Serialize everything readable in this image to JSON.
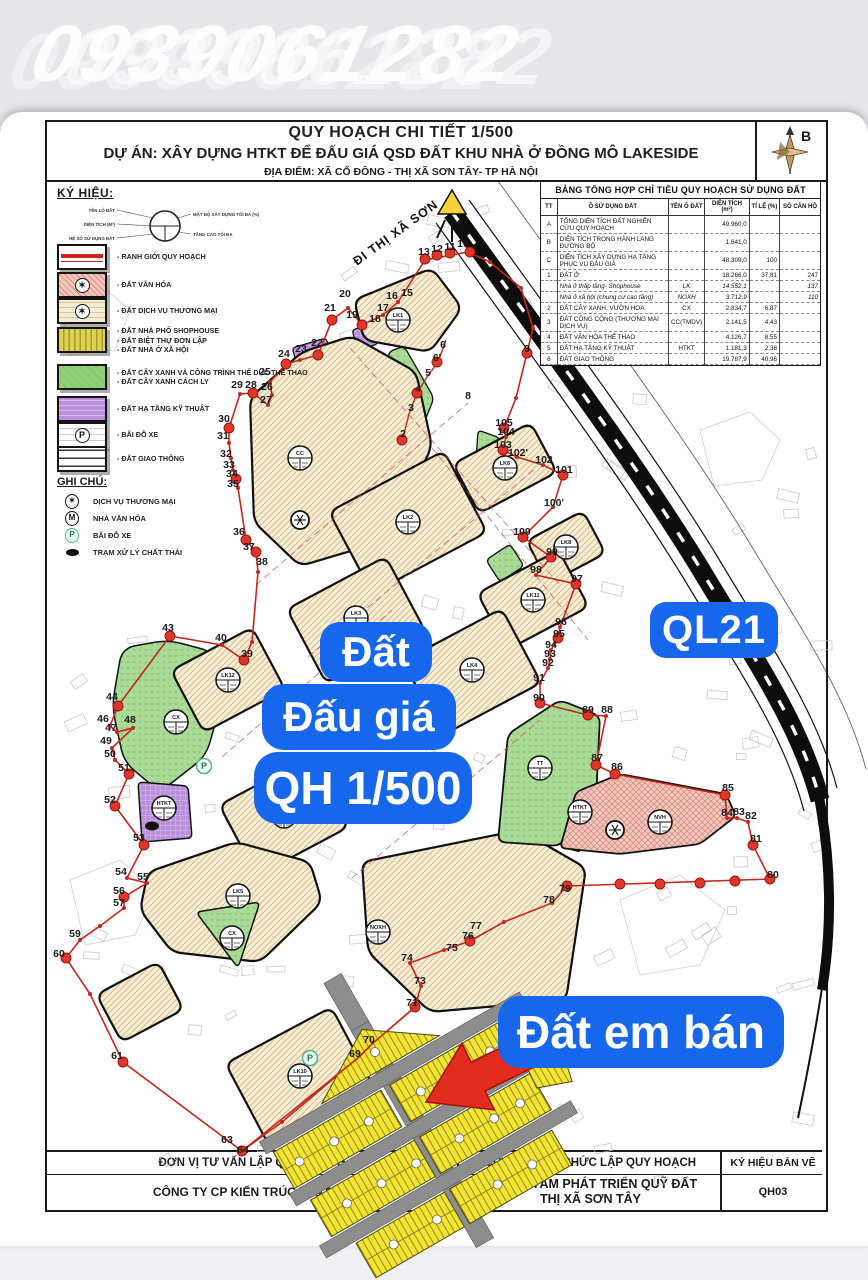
{
  "watermark": "0939061282",
  "title_block": {
    "line1": "QUY HOẠCH CHI TIẾT 1/500",
    "line2": "DỰ ÁN: XÂY DỰNG HTKT ĐỂ ĐẤU GIÁ QSD ĐẤT KHU NHÀ Ở ĐỒNG MÔ LAKESIDE",
    "line3": "ĐỊA ĐIỂM: XÃ CỔ ĐÔNG - THỊ XÃ SƠN TÂY- TP HÀ NỘI",
    "compass_label": "B"
  },
  "legend": {
    "heading": "KÝ HIỆU:",
    "diagram_left_labels": [
      "TÊN LÔ ĐẤT",
      "DIỆN TÍCH (M²)",
      "HỆ SỐ SỬ DỤNG ĐẤT"
    ],
    "diagram_right_labels": [
      "MẬT ĐỘ XÂY DỰNG TỐI ĐA (%)",
      "TẦNG CAO TỐI ĐA"
    ],
    "items": [
      {
        "swatch": "boundary",
        "lines": [
          "- RANH GIỚI QUY HOẠCH"
        ]
      },
      {
        "swatch": "culture",
        "sym": "✶",
        "lines": [
          "- ĐẤT VĂN HÓA"
        ]
      },
      {
        "swatch": "commerce",
        "sym": "✶",
        "lines": [
          "- ĐẤT DỊCH VỤ THƯƠNG MẠI"
        ]
      },
      {
        "swatch": "housing",
        "lines": [
          "- ĐẤT NHÀ PHỐ SHOPHOUSE",
          "- ĐẤT BIỆT THỰ ĐƠN LẬP",
          "- ĐẤT NHÀ Ở XÃ HỘI"
        ]
      },
      {
        "swatch": "green",
        "lines": [
          "- ĐẤT CÂY XANH VÀ CÔNG TRÌNH THỂ DỤC THỂ THAO",
          "- ĐẤT CÂY XANH CÁCH LY"
        ]
      },
      {
        "swatch": "infra",
        "lines": [
          "- ĐẤT HẠ TẦNG KỸ THUẬT"
        ]
      },
      {
        "swatch": "parking",
        "sym": "P",
        "lines": [
          "- BÃI ĐỖ XE"
        ]
      },
      {
        "swatch": "traffic",
        "lines": [
          "- ĐẤT GIAO THÔNG"
        ]
      }
    ],
    "notes_heading": "GHI CHÚ:",
    "notes": [
      {
        "icon": "tm",
        "label": "DỊCH VỤ THƯƠNG MẠI"
      },
      {
        "icon": "m",
        "label": "NHÀ VĂN HÓA"
      },
      {
        "icon": "p",
        "label": "BÃI ĐỖ XE"
      },
      {
        "icon": "waste",
        "label": "TRẠM XỬ LÝ CHẤT THẢI"
      }
    ]
  },
  "table": {
    "title": "BẢNG TỔNG HỢP CHỈ TIÊU QUY HOẠCH SỬ DỤNG ĐẤT",
    "headers": [
      "TT",
      "Ô SỬ DỤNG ĐẤT",
      "TÊN Ô ĐẤT",
      "DIỆN TÍCH (m²)",
      "TỈ LỆ (%)",
      "SỐ CĂN HỘ"
    ],
    "rows": [
      {
        "tt": "A",
        "name": "TỔNG DIỆN TÍCH ĐẤT NGHIÊN CỨU QUY HOẠCH",
        "ten": "",
        "dt": "49.960,0",
        "tl": "",
        "so": "",
        "sub": false
      },
      {
        "tt": "B",
        "name": "DIỆN TÍCH TRONG HÀNH LANG ĐƯỜNG BỘ",
        "ten": "",
        "dt": "1.641,0",
        "tl": "",
        "so": "",
        "sub": false
      },
      {
        "tt": "C",
        "name": "DIỆN TÍCH XÂY DỰNG HẠ TẦNG PHỤC VỤ ĐẤU GIÁ",
        "ten": "",
        "dt": "48.309,0",
        "tl": "100",
        "so": "",
        "sub": false
      },
      {
        "tt": "1",
        "name": "ĐẤT Ở",
        "ten": "",
        "dt": "18.266,0",
        "tl": "37,81",
        "so": "247",
        "sub": false
      },
      {
        "tt": "",
        "name": "Nhà ở thấp tầng- Shophouse",
        "ten": "LK",
        "dt": "14.552,1",
        "tl": "",
        "so": "137",
        "sub": true
      },
      {
        "tt": "",
        "name": "Nhà ở xã hội (chung cư cao tầng)",
        "ten": "NOXH",
        "dt": "3.712,9",
        "tl": "",
        "so": "110",
        "sub": true
      },
      {
        "tt": "2",
        "name": "ĐẤT CÂY XANH, VƯỜN HOA",
        "ten": "CX",
        "dt": "2.834,7",
        "tl": "6,87",
        "so": "",
        "sub": false
      },
      {
        "tt": "3",
        "name": "ĐẤT CÔNG CỘNG (THƯƠNG MẠI DỊCH VỤ)",
        "ten": "CC(TMDV)",
        "dt": "2.141,5",
        "tl": "4,43",
        "so": "",
        "sub": false
      },
      {
        "tt": "4",
        "name": "ĐẤT VĂN HÓA THỂ THAO",
        "ten": "",
        "dt": "4.126,7",
        "tl": "8,55",
        "so": "",
        "sub": false
      },
      {
        "tt": "5",
        "name": "ĐẤT HẠ TẦNG KỸ THUẬT",
        "ten": "HTKT",
        "dt": "1.181,3",
        "tl": "2,38",
        "so": "",
        "sub": false
      },
      {
        "tt": "6",
        "name": "ĐẤT GIAO THÔNG",
        "ten": "",
        "dt": "19.787,9",
        "tl": "40,96",
        "so": "",
        "sub": false
      }
    ]
  },
  "map": {
    "road_label": "ĐI THỊ XÃ SƠN",
    "overlays": {
      "dat": "Đất",
      "daugia": "Đấu giá",
      "qh": "QH 1/500",
      "ql21": "QL21",
      "datban": "Đất em bán"
    },
    "boundary_points": [
      [
        "2",
        403,
        437
      ],
      [
        "3",
        411,
        411
      ],
      [
        "4",
        418,
        392
      ],
      [
        "5",
        428,
        376
      ],
      [
        "6",
        443,
        348
      ],
      [
        "6'",
        437,
        361
      ],
      [
        "8",
        468,
        399
      ],
      [
        "9",
        527,
        352
      ],
      [
        "10",
        463,
        247
      ],
      [
        "11",
        450,
        250
      ],
      [
        "12",
        437,
        252
      ],
      [
        "13",
        424,
        255
      ],
      [
        "15",
        407,
        296
      ],
      [
        "16",
        392,
        299
      ],
      [
        "17",
        383,
        311
      ],
      [
        "18",
        375,
        322
      ],
      [
        "19",
        352,
        318
      ],
      [
        "20",
        345,
        297
      ],
      [
        "21",
        330,
        311
      ],
      [
        "22",
        317,
        346
      ],
      [
        "23",
        301,
        352
      ],
      [
        "24",
        284,
        357
      ],
      [
        "25",
        265,
        375
      ],
      [
        "26",
        267,
        390
      ],
      [
        "27",
        266,
        403
      ],
      [
        "28",
        251,
        388
      ],
      [
        "29",
        237,
        388
      ],
      [
        "30",
        224,
        422
      ],
      [
        "31",
        223,
        439
      ],
      [
        "32",
        226,
        457
      ],
      [
        "33",
        229,
        468
      ],
      [
        "34",
        232,
        477
      ],
      [
        "35",
        233,
        487
      ],
      [
        "36",
        239,
        535
      ],
      [
        "37",
        249,
        550
      ],
      [
        "38",
        262,
        565
      ],
      [
        "39",
        247,
        657
      ],
      [
        "40",
        221,
        641
      ],
      [
        "43",
        168,
        631
      ],
      [
        "44",
        112,
        700
      ],
      [
        "46",
        103,
        722
      ],
      [
        "47",
        111,
        731
      ],
      [
        "48",
        130,
        723
      ],
      [
        "49",
        106,
        744
      ],
      [
        "50",
        110,
        757
      ],
      [
        "51",
        124,
        771
      ],
      [
        "52",
        110,
        803
      ],
      [
        "53",
        139,
        841
      ],
      [
        "54",
        121,
        875
      ],
      [
        "55",
        143,
        880
      ],
      [
        "56",
        119,
        894
      ],
      [
        "57",
        119,
        906
      ],
      [
        "59",
        75,
        937
      ],
      [
        "60",
        59,
        957
      ],
      [
        "61",
        117,
        1059
      ],
      [
        "63",
        227,
        1143
      ],
      [
        "64",
        243,
        1153
      ],
      [
        "69",
        355,
        1057
      ],
      [
        "70",
        369,
        1043
      ],
      [
        "71",
        412,
        1006
      ],
      [
        "73",
        420,
        984
      ],
      [
        "74",
        407,
        961
      ],
      [
        "75",
        452,
        951
      ],
      [
        "76",
        468,
        939
      ],
      [
        "77",
        476,
        929
      ],
      [
        "78",
        549,
        903
      ],
      [
        "79",
        565,
        892
      ],
      [
        "80",
        773,
        878
      ],
      [
        "81",
        756,
        842
      ],
      [
        "82",
        751,
        819
      ],
      [
        "83",
        739,
        815
      ],
      [
        "84",
        727,
        816
      ],
      [
        "85",
        728,
        791
      ],
      [
        "86",
        617,
        770
      ],
      [
        "87",
        597,
        761
      ],
      [
        "88",
        607,
        713
      ],
      [
        "89",
        588,
        713
      ],
      [
        "90",
        539,
        701
      ],
      [
        "91",
        539,
        681
      ],
      [
        "92",
        548,
        666
      ],
      [
        "93",
        550,
        657
      ],
      [
        "94",
        551,
        648
      ],
      [
        "95",
        559,
        637
      ],
      [
        "96",
        561,
        625
      ],
      [
        "97",
        577,
        582
      ],
      [
        "98",
        536,
        573
      ],
      [
        "99",
        552,
        555
      ],
      [
        "100",
        522,
        535
      ],
      [
        "100'",
        554,
        506
      ],
      [
        "101",
        564,
        473
      ],
      [
        "102",
        544,
        463
      ],
      [
        "102'",
        518,
        456
      ],
      [
        "103",
        503,
        448
      ],
      [
        "104",
        506,
        435
      ],
      [
        "105",
        504,
        426
      ]
    ],
    "lot_circles": [
      [
        "LK1",
        398,
        320
      ],
      [
        "CC",
        300,
        458
      ],
      [
        "LK2",
        408,
        522
      ],
      [
        "LK3",
        356,
        618
      ],
      [
        "LK4",
        472,
        670
      ],
      [
        "LK5",
        238,
        896
      ],
      [
        "LK6",
        505,
        468
      ],
      [
        "LK7",
        284,
        816
      ],
      [
        "LK8",
        566,
        547
      ],
      [
        "LK10",
        300,
        1076
      ],
      [
        "LK11",
        533,
        600
      ],
      [
        "LK12",
        228,
        680
      ],
      [
        "NOXH",
        378,
        932
      ],
      [
        "TT",
        540,
        768
      ],
      [
        "NVH",
        660,
        822
      ],
      [
        "CX",
        232,
        938
      ],
      [
        "CX",
        176,
        722
      ],
      [
        "HTKT",
        164,
        808
      ],
      [
        "HTKT",
        580,
        812
      ]
    ]
  },
  "footer": {
    "col1_top": "ĐƠN VỊ TƯ VẤN LẬP QUY HOẠCH",
    "col1_bottom": "CÔNG TY CP KIẾN TRÚC VT&T HÀ",
    "col2_top": "CƠ QUAN TỔ CHỨC LẬP QUY HOẠCH",
    "col2_bottom_line1": "TRUNG TÂM PHÁT TRIỂN QUỸ ĐẤT",
    "col2_bottom_line2": "THỊ XÃ SƠN TÂY",
    "col3_top": "KÝ HIỆU BẢN VẼ",
    "col3_bottom": "QH03"
  },
  "colors": {
    "accent_blue": "#1767ec",
    "arrow_red": "#e22c1e",
    "boundary_red": "#c2271f",
    "plot_yellow": "#f3e432",
    "block_tan": "#f6eed8",
    "green": "#a9da96",
    "purple": "#ba90dd",
    "pink": "#f1c6bd"
  }
}
